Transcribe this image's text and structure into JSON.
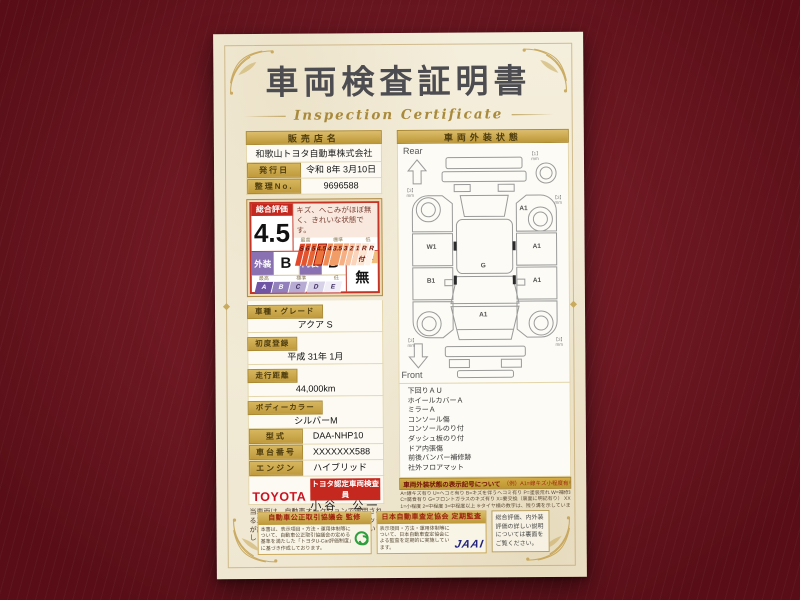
{
  "page": {
    "title": "車両検査証明書",
    "subtitle": "Inspection Certificate"
  },
  "colors": {
    "background_maroon": "#7b1420",
    "paper_cream": "#f2ecd9",
    "gold_bar": "#c9a545",
    "rating_red": "#c5281e",
    "toyota_red": "#cc1122",
    "jaai_blue": "#22227e"
  },
  "left": {
    "dealer_header": "販売店名",
    "dealer_name": "和歌山トヨタ自動車株式会社",
    "issue_date_label": "発行日",
    "issue_date": "令和 8年 3月10日",
    "ref_no_label": "整理No.",
    "ref_no": "9696588",
    "rating": {
      "header": "総合評価",
      "score": "4.5",
      "comment": "キズ、へこみがほぼ無く、きれいな状態です。",
      "scale_headers": [
        "最高",
        "標準",
        "低"
      ],
      "scale": [
        "S",
        "6",
        "5",
        "4.5",
        "4",
        "3.5",
        "3",
        "2",
        "1",
        "R付",
        "R"
      ],
      "exterior_label": "外装",
      "exterior_grade": "B",
      "interior_label": "内装",
      "interior_grade": "B",
      "repair_label": "修復歴",
      "repair_value": "無",
      "grade_headers": [
        "最高",
        "標準",
        "低"
      ],
      "grades": [
        "A",
        "B",
        "C",
        "D",
        "E"
      ]
    },
    "fields": [
      {
        "label": "車種・グレード",
        "value": "アクア S"
      },
      {
        "label": "初度登録",
        "value": "平成 31年 1月"
      },
      {
        "label": "走行距離",
        "value": "44,000km"
      },
      {
        "label": "ボディーカラー",
        "value": "シルバーM"
      },
      {
        "label": "型式",
        "value": "DAA-NHP10"
      },
      {
        "label": "車台番号",
        "value": "XXXXXXX588"
      },
      {
        "label": "エンジン",
        "value": "ハイブリッド"
      }
    ],
    "inspector": {
      "brand": "TOYOTA",
      "badge": "トヨタ認定車両検査員",
      "name": "小谷　公一"
    },
    "disclaimer": "当車両は、自動車オークションで適用される車両評価基準に沿い、トヨタユーゼックが認定した検査員が厳正に検査・評価いたしました。"
  },
  "right": {
    "header": "車両外装状態",
    "rear_label": "Rear",
    "front_label": "Front",
    "marks": {
      "unit": "mm",
      "spare_tread": "【1】",
      "rear_left_tread": "【3】",
      "rear_right_tread": "【3】",
      "front_left_tread": "【3】",
      "front_right_tread": "【3】",
      "left_front_door": "W1",
      "left_rear_door": "B1",
      "right_fender": "A1",
      "right_front_door": "A1",
      "right_rear_door": "A1",
      "roof": "G",
      "hood": "A1"
    },
    "conditions": [
      "下回りＡＵ",
      "ホイールカバーＡ",
      "ミラーＡ",
      "コンソール傷",
      "コンソールのり付",
      "ダッシュ板のり付",
      "ドア内張傷",
      "前後バンパー補修跡",
      "社外フロアマット"
    ],
    "legend_title": "車両外装状態の表示記号について",
    "legend_example": "（例）A1=線キズ小程度有り",
    "legend_lines": [
      "A=線キズ有り U=ヘコミ有り B=キズを伴うヘコミ有り P=塗装荒れ W=補修跡有り S=サビ有り",
      "C=腐食有り G=フロントガラスのキズ有り X=要交換（裏面に明記有り） XX=交換済有り",
      "1=小程度 2=中程度 3=中程度以上 ※タイヤ横の数字は、残り溝を示しています。"
    ]
  },
  "footer": {
    "box1_title": "自動車公正取引協議会 監修",
    "box1_text": "本書は、表示項目・方法・運用体制等について、自動車公正取引協議会の定める基準を満たした「トヨタU-Car評価制度」に基づき作成しております。",
    "box2_title": "日本自動車査定協会 定期監査",
    "box2_text": "表示項目・方法・運用体制等について、日本自動車査定協会による監査を定期的に実施しています。",
    "box2_logo": "JAAI",
    "box3_text": "総合評価、内外装評価の詳しい説明については裏面をご覧ください。"
  }
}
